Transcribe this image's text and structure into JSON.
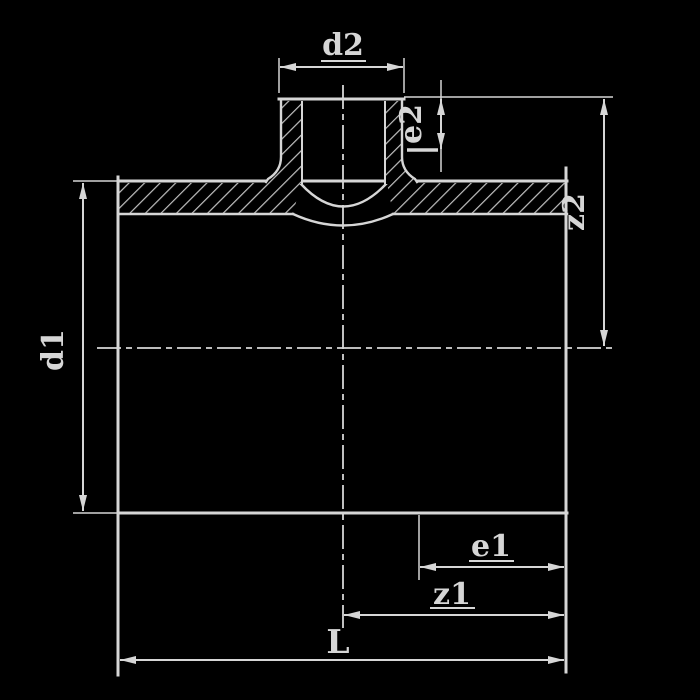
{
  "diagram": {
    "type": "technical-drawing",
    "subject": "pipe tee fitting cross-section with socket branch",
    "colors": {
      "background": "#000000",
      "line": "#d6d6d6",
      "hatch": "#c0c0c0",
      "text": "#d6d6d6"
    },
    "labels": {
      "d2": "d2",
      "e2": "e2",
      "z2": "z2",
      "d1": "d1",
      "e1": "e1",
      "z1": "z1",
      "L": "L"
    },
    "dimensions": [
      {
        "id": "d2",
        "orientation": "horizontal",
        "underlined": true
      },
      {
        "id": "e2",
        "orientation": "vertical",
        "rotated": true
      },
      {
        "id": "z2",
        "orientation": "vertical",
        "rotated": true
      },
      {
        "id": "d1",
        "orientation": "vertical",
        "rotated": true
      },
      {
        "id": "e1",
        "orientation": "horizontal",
        "underlined": true
      },
      {
        "id": "z1",
        "orientation": "horizontal",
        "underlined": true
      },
      {
        "id": "L",
        "orientation": "horizontal"
      }
    ]
  }
}
